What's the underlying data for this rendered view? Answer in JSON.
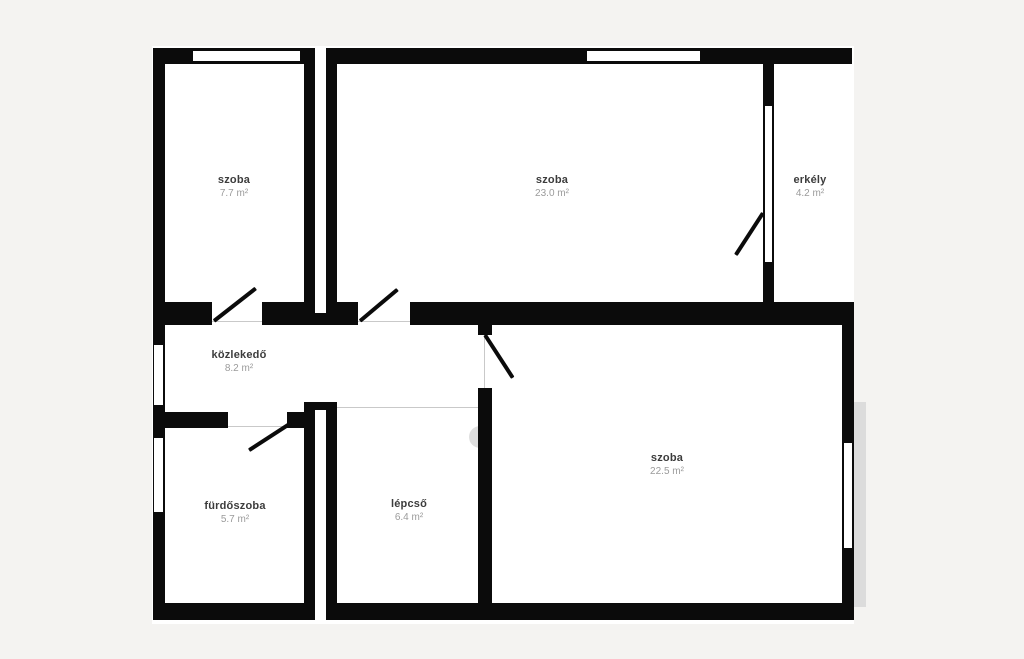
{
  "plan_title": "apartment-floor-plan",
  "colors": {
    "background": "#f4f3f1",
    "plan_fill": "#ffffff",
    "wall": "#0b0b0b",
    "room_name_text": "#3c3c3c",
    "room_area_text": "#9b9b9b",
    "shadow": "#dcdcdc",
    "opening_line": "#c9c9c9"
  },
  "rooms": [
    {
      "name": "szoba",
      "area": "7.7 m²"
    },
    {
      "name": "szoba",
      "area": "23.0 m²"
    },
    {
      "name": "erkély",
      "area": "4.2 m²"
    },
    {
      "name": "közlekedő",
      "area": "8.2 m²"
    },
    {
      "name": "szoba",
      "area": "22.5 m²"
    },
    {
      "name": "fürdőszoba",
      "area": "5.7 m²"
    },
    {
      "name": "lépcső",
      "area": "6.4 m²"
    }
  ]
}
